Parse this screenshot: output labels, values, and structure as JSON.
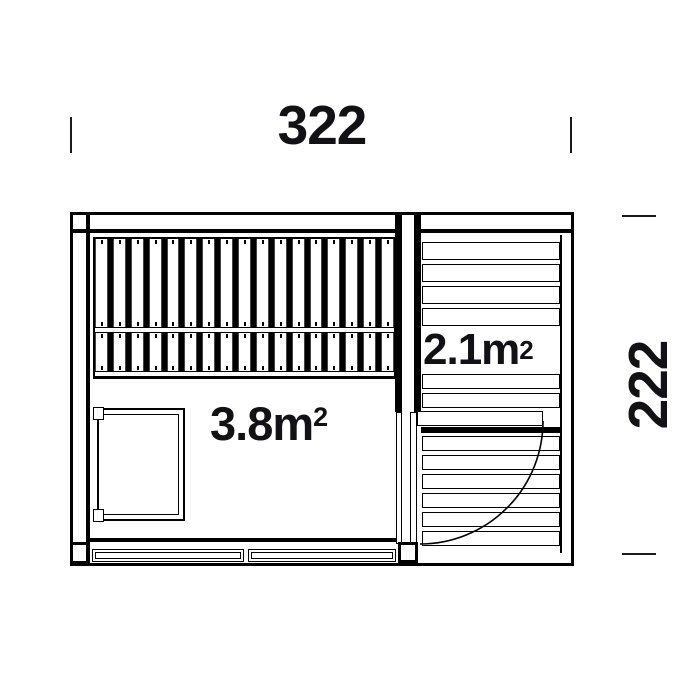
{
  "colors": {
    "line": "#000000",
    "text": "#121216",
    "background": "#ffffff"
  },
  "dimensions": {
    "top": {
      "value": "322"
    },
    "right": {
      "value": "222"
    }
  },
  "rooms": {
    "main_room": {
      "area_base": "3.8m",
      "area_sup": "2",
      "area_full": "3.8m²"
    },
    "terrace": {
      "area_base": "2.1m",
      "area_sup": "2",
      "area_full": "2.1m²"
    }
  },
  "structure": {
    "bench_slat_rows": 2,
    "bench_slats_per_row": 17,
    "terrace_boards_above_label": 4,
    "terrace_boards_below_label": 8,
    "front_wall_panels": 2,
    "door_swing": "quarter-arc"
  }
}
